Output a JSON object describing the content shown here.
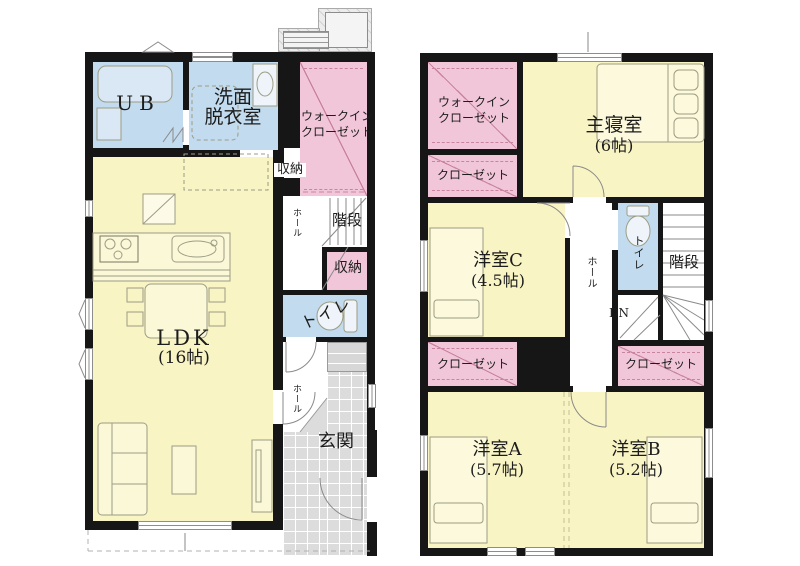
{
  "colors": {
    "wall": "#161616",
    "room_yellow": "#f8f4c4",
    "room_blue": "#c2dbee",
    "room_pink": "#f2c6d9",
    "closet_line": "#c9849f",
    "tile_gray": "#dcdcdc",
    "equip_gray": "#ececec",
    "text": "#1c1c1c",
    "furniture_stroke": "#9d9d85",
    "door_stroke": "#8a8a8a"
  },
  "floor1": {
    "ub_label": "UB",
    "washroom_line1": "洗面",
    "washroom_line2": "脱衣室",
    "wic_line1": "ウォークイン",
    "wic_line2": "クローゼット",
    "storage_upper_label": "収納",
    "hall_mid_label": "ホール",
    "stairs_label": "階段",
    "storage_mid_label": "収納",
    "toilet_label": "トイレ",
    "ldk_label": "LDK",
    "ldk_size": "(16帖)",
    "hall_entry_label": "ホール",
    "entrance_label": "玄関"
  },
  "floor2": {
    "wic_line1": "ウォークイン",
    "wic_line2": "クローゼット",
    "master_label": "主寝室",
    "master_size": "(6帖)",
    "closet_master_label": "クローゼット",
    "room_c_label": "洋室C",
    "room_c_size": "(4.5帖)",
    "hall_label": "ホール",
    "toilet_label": "トイレ",
    "stairs_label": "階段",
    "down_label": "DN",
    "closet_left_label": "クローゼット",
    "closet_right_label": "クローゼット",
    "room_a_label": "洋室A",
    "room_a_size": "(5.7帖)",
    "room_b_label": "洋室B",
    "room_b_size": "(5.2帖)"
  }
}
